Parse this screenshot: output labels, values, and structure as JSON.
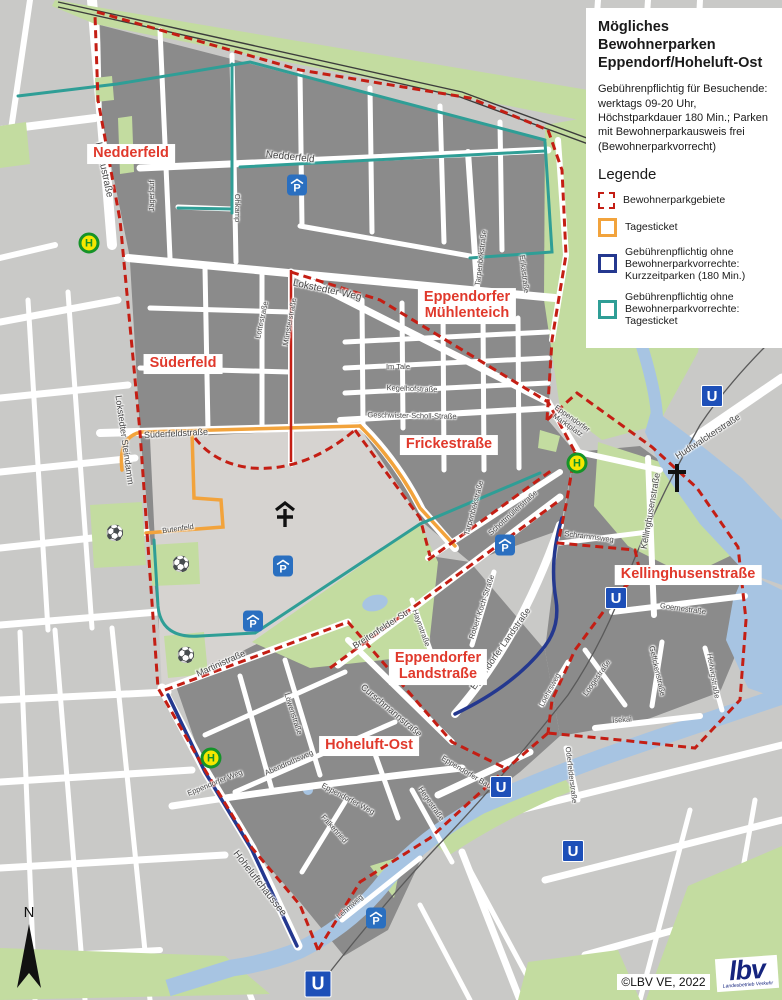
{
  "panel": {
    "title": "Mögliches Bewohnerparken Eppendorf/Hoheluft-Ost",
    "description": "Gebührenpflichtig für Besuchende: werktags 09-20 Uhr, Höchstparkdauer 180 Min.; Parken mit Bewohnerparkausweis frei (Bewohnerparkvorrecht)",
    "legend_heading": "Legende",
    "legend_items": [
      {
        "style": "dashed-red",
        "label": "Bewohnerparkgebiete"
      },
      {
        "style": "solid-orange",
        "label": "Tagesticket"
      },
      {
        "style": "solid-navy",
        "label": "Gebührenpflichtig ohne Bewohnerparkvorrechte: Kurzzeitparken (180 Min.)"
      },
      {
        "style": "solid-teal",
        "label": "Gebührenpflichtig ohne Bewohnerparkvorrechte: Tagesticket"
      }
    ]
  },
  "attribution": {
    "copyright": "©LBV VE, 2022",
    "logo_text": "lbv",
    "logo_subtext": "Landesbetrieb Verkehr"
  },
  "north_label": "N",
  "colors": {
    "zone_border": "#c41e14",
    "tagesticket": "#f2a33c",
    "kurzzeitparken": "#24388f",
    "tagesticket_ohne": "#2f9e96",
    "zone_label_red": "#e0392c",
    "water": "#a7c4e2",
    "park": "#c3dca0",
    "block_dark": "#8b8b8b",
    "block_light": "#d6d3d0",
    "outside": "#c9c9c7"
  },
  "zone_labels": [
    {
      "text": "Nedderfeld",
      "x": 131,
      "y": 154
    },
    {
      "text": "Süderfeld",
      "x": 183,
      "y": 364
    },
    {
      "text": "Eppendorfer\nMühlenteich",
      "x": 467,
      "y": 306
    },
    {
      "text": "Frickestraße",
      "x": 449,
      "y": 445
    },
    {
      "text": "Kellinghusenstraße",
      "x": 688,
      "y": 575
    },
    {
      "text": "Eppendorfer\nLandstraße",
      "x": 438,
      "y": 667
    },
    {
      "text": "Hoheluft-Ost",
      "x": 369,
      "y": 746
    }
  ],
  "street_labels": [
    {
      "text": "Kollaustraße",
      "x": 103,
      "y": 170,
      "rot": 78,
      "size": "lg"
    },
    {
      "text": "Nedderfeld",
      "x": 290,
      "y": 158,
      "rot": 6,
      "size": "lg"
    },
    {
      "text": "Jägerlauf",
      "x": 152,
      "y": 196,
      "rot": -90,
      "size": "sm"
    },
    {
      "text": "Ohkamp",
      "x": 237,
      "y": 208,
      "rot": 90,
      "size": "sm"
    },
    {
      "text": "Lokstedter Weg",
      "x": 327,
      "y": 291,
      "rot": 12,
      "size": "lg"
    },
    {
      "text": "Lottestraße",
      "x": 262,
      "y": 320,
      "rot": -78,
      "size": "sm"
    },
    {
      "text": "Münsterstraße",
      "x": 290,
      "y": 322,
      "rot": -80,
      "size": "sm"
    },
    {
      "text": "Lokstedter Steindamm",
      "x": 124,
      "y": 440,
      "rot": 82
    },
    {
      "text": "Süderfeldstraße",
      "x": 176,
      "y": 434,
      "rot": -3
    },
    {
      "text": "Butenfeld",
      "x": 178,
      "y": 529,
      "rot": -8,
      "size": "sm"
    },
    {
      "text": "Im Tale",
      "x": 398,
      "y": 367,
      "rot": 0,
      "size": "sm"
    },
    {
      "text": "Kegelhofstraße",
      "x": 412,
      "y": 389,
      "rot": 2,
      "size": "sm"
    },
    {
      "text": "Geschwister-Scholl-Straße",
      "x": 412,
      "y": 416,
      "rot": 1,
      "size": "sm"
    },
    {
      "text": "Tarpenbekstraße",
      "x": 481,
      "y": 258,
      "rot": -83,
      "size": "sm"
    },
    {
      "text": "Erikastraße",
      "x": 524,
      "y": 274,
      "rot": 83,
      "size": "sm"
    },
    {
      "text": "Tarpenbekstraße",
      "x": 474,
      "y": 508,
      "rot": -75,
      "size": "sm"
    },
    {
      "text": "Schottmüllerstraße",
      "x": 513,
      "y": 513,
      "rot": -42,
      "size": "sm"
    },
    {
      "text": "Eppendorfer\nMarktplatz",
      "x": 570,
      "y": 422,
      "rot": 35,
      "size": "sm"
    },
    {
      "text": "Hudtwalckerstraße",
      "x": 708,
      "y": 437,
      "rot": -33
    },
    {
      "text": "Kellinghusenstraße",
      "x": 651,
      "y": 511,
      "rot": -80
    },
    {
      "text": "Schrammsweg",
      "x": 589,
      "y": 537,
      "rot": 7,
      "size": "sm"
    },
    {
      "text": "Robert-Koch-Straße",
      "x": 482,
      "y": 607,
      "rot": -72,
      "size": "sm"
    },
    {
      "text": "Breitenfelder Str.",
      "x": 382,
      "y": 629,
      "rot": -33
    },
    {
      "text": "Haynstraße",
      "x": 421,
      "y": 628,
      "rot": 70,
      "size": "sm"
    },
    {
      "text": "Eppendorfer Landstraße",
      "x": 501,
      "y": 649,
      "rot": -55
    },
    {
      "text": "Goernestraße",
      "x": 683,
      "y": 609,
      "rot": 8,
      "size": "sm"
    },
    {
      "text": "Loogestraße",
      "x": 597,
      "y": 678,
      "rot": -55,
      "size": "sm"
    },
    {
      "text": "Loehrsweg",
      "x": 550,
      "y": 690,
      "rot": -62,
      "size": "sm"
    },
    {
      "text": "Geffckenstraße",
      "x": 657,
      "y": 671,
      "rot": 77,
      "size": "sm"
    },
    {
      "text": "Heilwigstraße",
      "x": 713,
      "y": 676,
      "rot": 80,
      "size": "sm"
    },
    {
      "text": "Isekai",
      "x": 622,
      "y": 720,
      "rot": -4,
      "size": "sm"
    },
    {
      "text": "Oderfelderstraße",
      "x": 571,
      "y": 775,
      "rot": 83,
      "size": "sm"
    },
    {
      "text": "Martinistraße",
      "x": 221,
      "y": 664,
      "rot": -24
    },
    {
      "text": "Löwenstraße",
      "x": 293,
      "y": 714,
      "rot": 72,
      "size": "sm"
    },
    {
      "text": "Curschmannstraße",
      "x": 391,
      "y": 711,
      "rot": 40
    },
    {
      "text": "Abendrothsweg",
      "x": 289,
      "y": 763,
      "rot": -24,
      "size": "sm"
    },
    {
      "text": "Eppendorfer Weg",
      "x": 215,
      "y": 783,
      "rot": -22,
      "size": "sm"
    },
    {
      "text": "Eppendorfer Weg",
      "x": 348,
      "y": 799,
      "rot": 28,
      "size": "sm"
    },
    {
      "text": "Hoheluftchaussee",
      "x": 259,
      "y": 884,
      "rot": 52,
      "size": "lg"
    },
    {
      "text": "Falkenried",
      "x": 334,
      "y": 829,
      "rot": 48,
      "size": "sm"
    },
    {
      "text": "Lehmweg",
      "x": 350,
      "y": 907,
      "rot": -42,
      "size": "sm"
    },
    {
      "text": "Hegestraße",
      "x": 431,
      "y": 804,
      "rot": 55,
      "size": "sm"
    },
    {
      "text": "Eppendorfer Baum",
      "x": 469,
      "y": 774,
      "rot": 31,
      "size": "sm"
    }
  ],
  "icons": [
    {
      "type": "bus",
      "x": 89,
      "y": 243
    },
    {
      "type": "bus",
      "x": 577,
      "y": 463
    },
    {
      "type": "bus",
      "x": 211,
      "y": 758
    },
    {
      "type": "u",
      "x": 712,
      "y": 396
    },
    {
      "type": "u",
      "x": 616,
      "y": 598
    },
    {
      "type": "u",
      "x": 501,
      "y": 787
    },
    {
      "type": "u",
      "x": 573,
      "y": 851
    },
    {
      "type": "u",
      "x": 318,
      "y": 984,
      "size": 25
    },
    {
      "type": "pg",
      "x": 297,
      "y": 185
    },
    {
      "type": "pg",
      "x": 283,
      "y": 566
    },
    {
      "type": "pg",
      "x": 253,
      "y": 621
    },
    {
      "type": "pg",
      "x": 505,
      "y": 545
    },
    {
      "type": "pg",
      "x": 376,
      "y": 918
    },
    {
      "type": "chapel",
      "x": 285,
      "y": 515
    },
    {
      "type": "church",
      "x": 677,
      "y": 478
    },
    {
      "type": "soccer",
      "x": 115,
      "y": 533
    },
    {
      "type": "soccer",
      "x": 181,
      "y": 564
    },
    {
      "type": "soccer",
      "x": 186,
      "y": 655
    }
  ]
}
